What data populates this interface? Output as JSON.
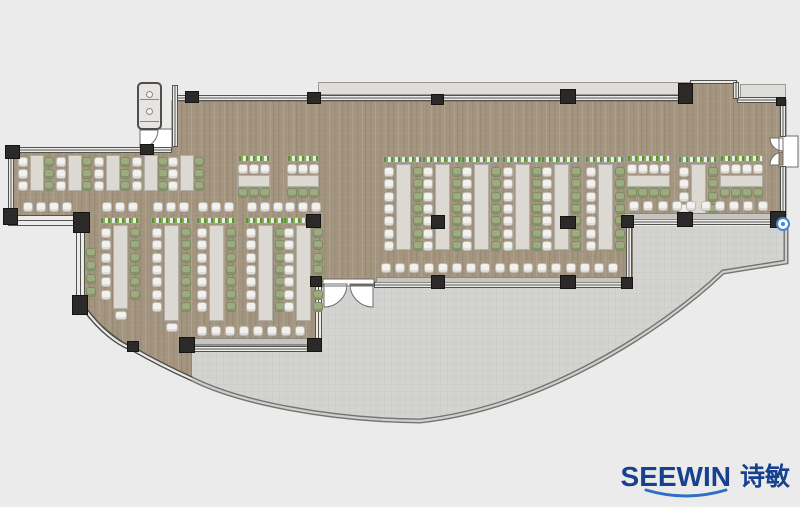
{
  "logo": {
    "brand": "SEEWIN",
    "brand_cn": "诗敏"
  },
  "palette": {
    "background": "#ebebeb",
    "carpet": "#a49581",
    "terrace": "#d3d3d1",
    "terrace_grid": "#c8c8c6",
    "terrace_edge": "#75736f",
    "wall_dark": "#55534e",
    "wall_fill": "#ebebe9",
    "column": "#2b2a28",
    "table": "#dcd9d3",
    "chair_white": "#f2f1ed",
    "chair_green": "#9dab81",
    "plant_green": "#5e8f3a",
    "logo_blue": "#17418f",
    "swoosh_blue": "#2e6ec4",
    "marker_blue": "#3f86d8"
  },
  "plan": {
    "paths": {
      "floor": "M172,101 L690,101 L690,82 L737,82 L737,100 L786,100 L786,222 L633,222 L633,285 L322,285 L322,347 L192,347 L192,378 C160,367 112,340 84,308 L84,222 L12,222 L12,150 L172,150 Z",
      "terrace": "M192,350 L322,350 L322,288 L633,288 L633,226 L786,226 L786,262 L723,272 C660,332 540,408 420,421 C330,420 240,403 192,379 Z",
      "terrace_edge": "M192,379 C240,403 330,420 420,421 C540,408 660,332 723,272 L786,262 L786,228",
      "glass_curve": "M84,308 C100,330 118,344 133,349 C152,360 172,370 192,379",
      "door_top_left": "M140,129 L172,129 L172,148 L140,148 Z M140,130 L158,130 A18,18 0 0 1 140,148 Z",
      "door_terrace": "M323,279 L374,279 L374,286 L323,286 Z M324,284 L347,284 A23,23 0 0 1 324,307 Z M373,284 L350,284 A23,23 0 0 0 373,307 Z",
      "door_right": "M779,136 L798,136 L798,167 L779,167 Z M783,138 L783,151 A13,13 0 0 1 770,138 Z M783,165 L783,152 A13,13 0 0 0 770,165 Z"
    },
    "ledges": [
      [
        318,
        82,
        372,
        13
      ],
      [
        740,
        84,
        46,
        15
      ]
    ],
    "walls_h": [
      [
        172,
        95,
        518,
        6
      ],
      [
        690,
        80,
        47,
        4
      ],
      [
        737,
        97,
        49,
        6
      ],
      [
        8,
        147,
        164,
        6
      ],
      [
        8,
        215,
        78,
        11
      ],
      [
        192,
        346,
        124,
        6
      ],
      [
        374,
        282,
        259,
        6
      ],
      [
        633,
        219,
        153,
        6
      ]
    ],
    "walls_v": [
      [
        172,
        85,
        6,
        62
      ],
      [
        8,
        147,
        6,
        75
      ],
      [
        76,
        226,
        9,
        76
      ],
      [
        733,
        82,
        6,
        17
      ],
      [
        780,
        101,
        6,
        36
      ],
      [
        780,
        166,
        6,
        48
      ],
      [
        315,
        284,
        7,
        62
      ],
      [
        626,
        225,
        6,
        58
      ]
    ],
    "columns": [
      [
        185,
        91,
        14,
        12
      ],
      [
        307,
        92,
        14,
        12
      ],
      [
        431,
        94,
        13,
        11
      ],
      [
        560,
        89,
        16,
        15
      ],
      [
        678,
        83,
        15,
        21
      ],
      [
        776,
        97,
        10,
        9
      ],
      [
        140,
        144,
        14,
        11
      ],
      [
        5,
        145,
        15,
        14
      ],
      [
        3,
        208,
        15,
        17
      ],
      [
        73,
        212,
        17,
        21
      ],
      [
        72,
        295,
        16,
        20
      ],
      [
        127,
        341,
        12,
        11
      ],
      [
        179,
        337,
        16,
        16
      ],
      [
        307,
        338,
        15,
        14
      ],
      [
        310,
        276,
        12,
        11
      ],
      [
        306,
        214,
        15,
        14
      ],
      [
        431,
        215,
        14,
        14
      ],
      [
        560,
        216,
        16,
        13
      ],
      [
        621,
        215,
        13,
        13
      ],
      [
        677,
        212,
        16,
        15
      ],
      [
        770,
        211,
        16,
        17
      ],
      [
        431,
        275,
        14,
        14
      ],
      [
        560,
        275,
        16,
        14
      ],
      [
        621,
        277,
        12,
        12
      ]
    ],
    "clusters": {
      "vrows": [
        {
          "x": 383,
          "y": 156,
          "len": 86,
          "seats": 7,
          "top": 0,
          "end": 0
        },
        {
          "x": 422,
          "y": 156,
          "len": 86,
          "seats": 7,
          "top": 0,
          "end": 0
        },
        {
          "x": 461,
          "y": 156,
          "len": 86,
          "seats": 7,
          "top": 0,
          "end": 0
        },
        {
          "x": 502,
          "y": 156,
          "len": 86,
          "seats": 7,
          "top": 0,
          "end": 0
        },
        {
          "x": 541,
          "y": 156,
          "len": 86,
          "seats": 7,
          "top": 0,
          "end": 0
        },
        {
          "x": 585,
          "y": 156,
          "len": 86,
          "seats": 7,
          "top": 0,
          "end": 0
        },
        {
          "x": 678,
          "y": 156,
          "len": 54,
          "seats": 4,
          "top": 0,
          "end": 0
        },
        {
          "x": 100,
          "y": 217,
          "len": 84,
          "seats": 6,
          "top": 3,
          "end": 1
        },
        {
          "x": 151,
          "y": 217,
          "len": 96,
          "seats": 7,
          "top": 3,
          "end": 1
        },
        {
          "x": 196,
          "y": 217,
          "len": 96,
          "seats": 7,
          "top": 3,
          "end": 0
        },
        {
          "x": 245,
          "y": 217,
          "len": 96,
          "seats": 7,
          "top": 3,
          "end": 0
        },
        {
          "x": 283,
          "y": 217,
          "len": 96,
          "seats": 7,
          "top": 3,
          "end": 0
        }
      ],
      "wing_rows": [
        {
          "x": 18,
          "y": 155,
          "len": 36,
          "seats": 3
        },
        {
          "x": 56,
          "y": 155,
          "len": 36,
          "seats": 3
        },
        {
          "x": 94,
          "y": 155,
          "len": 36,
          "seats": 3
        },
        {
          "x": 132,
          "y": 155,
          "len": 36,
          "seats": 3
        },
        {
          "x": 168,
          "y": 155,
          "len": 36,
          "seats": 3
        }
      ],
      "htables": [
        {
          "x": 238,
          "y": 155,
          "w": 32,
          "seats": 3
        },
        {
          "x": 287,
          "y": 155,
          "w": 32,
          "seats": 3
        },
        {
          "x": 627,
          "y": 155,
          "w": 43,
          "seats": 4
        },
        {
          "x": 720,
          "y": 155,
          "w": 43,
          "seats": 4
        }
      ],
      "bars": [
        {
          "chairs": [
            23,
            202,
            4,
            13
          ],
          "counter": null
        },
        {
          "chairs": [
            197,
            326,
            8,
            14
          ],
          "counter": [
            191,
            338,
            122,
            7
          ]
        },
        {
          "chairs": [
            381,
            263,
            17,
            14.2
          ],
          "counter": [
            376,
            277,
            249,
            6
          ]
        },
        {
          "chairs": [
            629,
            201,
            10,
            14.3
          ],
          "counter": [
            624,
            213,
            152,
            7
          ]
        }
      ],
      "wall_chairs": {
        "x": 86,
        "y": 248,
        "n": 4,
        "gap": 13
      }
    },
    "fixture": {
      "box": [
        137,
        82,
        25,
        48
      ],
      "knobs": [
        [
          146,
          91
        ],
        [
          146,
          108
        ]
      ],
      "lines": [
        99,
        121
      ]
    },
    "marker": [
      776,
      217,
      14,
      14
    ]
  }
}
